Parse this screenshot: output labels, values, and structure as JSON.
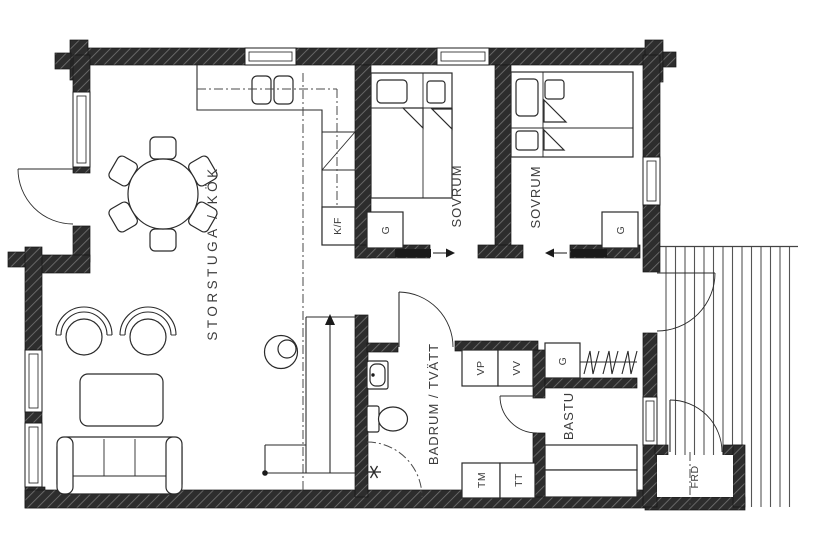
{
  "plan": {
    "type": "cottage-floor-plan",
    "rooms": {
      "storstuga_kok": "STORSTUGA / KÖK",
      "sovrum_1": "SOVRUM",
      "sovrum_2": "SOVRUM",
      "badrum_tvatt": "BADRUM / TVÄTT",
      "bastu": "BASTU",
      "frd": "FRD"
    },
    "units": {
      "kf": "K/F",
      "g_bedroom1": "G",
      "g_bedroom2": "G",
      "g_hall": "G",
      "vp": "VP",
      "vv": "VV",
      "tm": "TM",
      "tt": "TT"
    },
    "colors": {
      "background": "#ffffff",
      "wall_fill": "#2d2d2d",
      "wall_hatch": "#707070",
      "line": "#2a2a2a",
      "deck_plank": "#555555"
    }
  }
}
